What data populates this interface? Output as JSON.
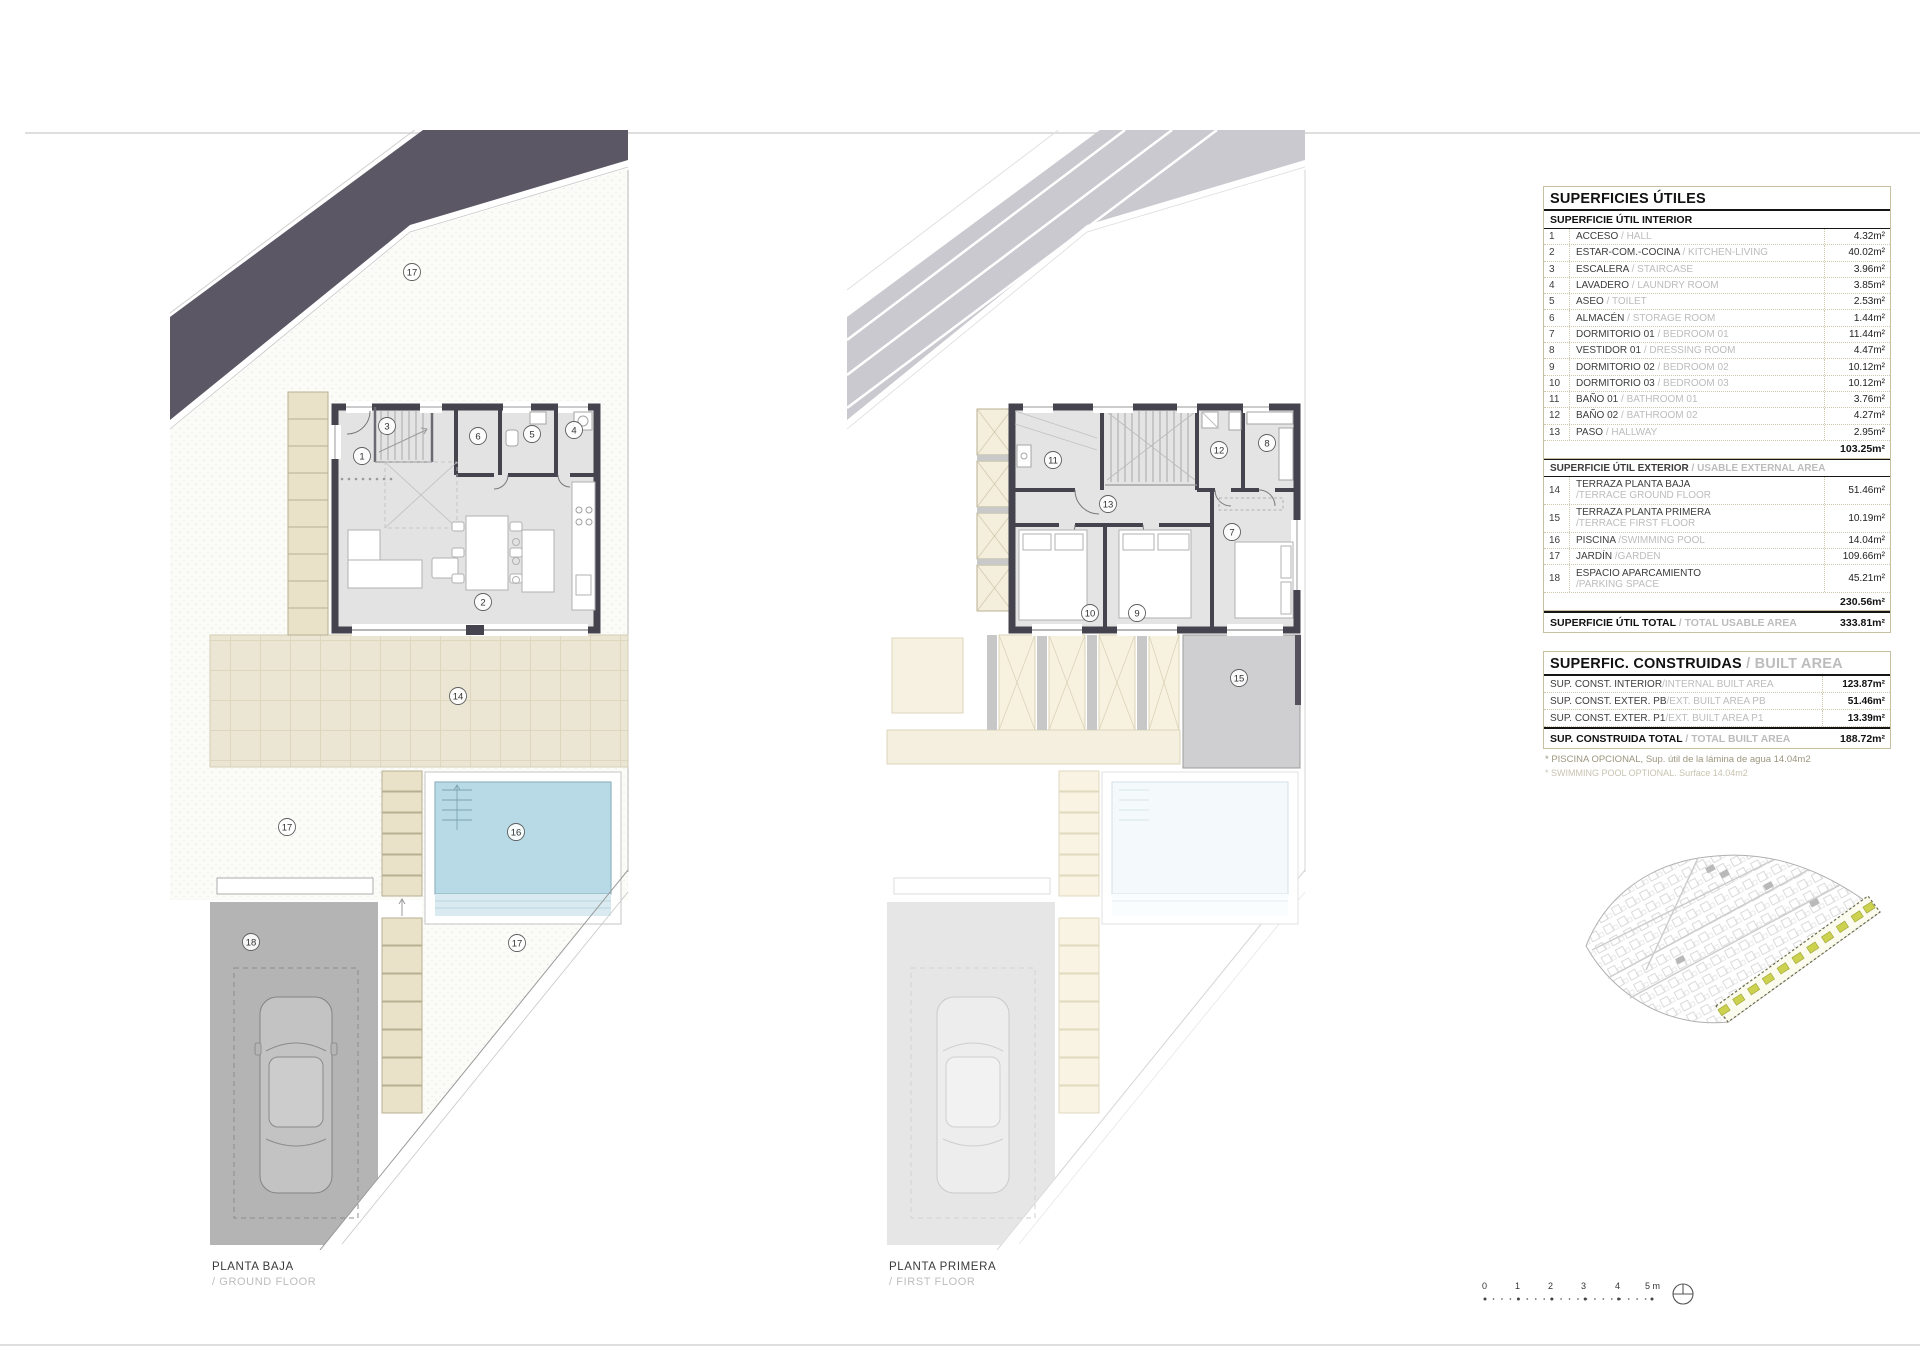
{
  "plans": {
    "ground": {
      "title": "PLANTA BAJA",
      "subtitle": "/ GROUND FLOOR",
      "room_numbers": [
        "17",
        "1",
        "3",
        "6",
        "5",
        "4",
        "2",
        "14",
        "17",
        "16",
        "18",
        "17"
      ]
    },
    "first": {
      "title": "PLANTA PRIMERA",
      "subtitle": "/ FIRST FLOOR",
      "room_numbers": [
        "11",
        "12",
        "8",
        "13",
        "7",
        "10",
        "9",
        "15"
      ]
    }
  },
  "usable_table": {
    "title": "SUPERFICIES ÚTILES",
    "interior_header": "SUPERFICIE ÚTIL INTERIOR",
    "interior_rows": [
      {
        "num": "1",
        "es": "ACCESO",
        "en": "/ HALL",
        "value": "4.32m²"
      },
      {
        "num": "2",
        "es": "ESTAR-COM.-COCINA",
        "en": "/ KITCHEN-LIVING",
        "value": "40.02m²"
      },
      {
        "num": "3",
        "es": "ESCALERA",
        "en": "/ STAIRCASE",
        "value": "3.96m²"
      },
      {
        "num": "4",
        "es": "LAVADERO",
        "en": "/ LAUNDRY ROOM",
        "value": "3.85m²"
      },
      {
        "num": "5",
        "es": "ASEO",
        "en": "/ TOILET",
        "value": "2.53m²"
      },
      {
        "num": "6",
        "es": "ALMACÉN",
        "en": "/ STORAGE ROOM",
        "value": "1.44m²"
      },
      {
        "num": "7",
        "es": "DORMITORIO 01",
        "en": "/ BEDROOM 01",
        "value": "11.44m²"
      },
      {
        "num": "8",
        "es": "VESTIDOR 01",
        "en": "/ DRESSING ROOM",
        "value": "4.47m²"
      },
      {
        "num": "9",
        "es": "DORMITORIO 02",
        "en": "/ BEDROOM 02",
        "value": "10.12m²"
      },
      {
        "num": "10",
        "es": "DORMITORIO 03",
        "en": "/ BEDROOM 03",
        "value": "10.12m²"
      },
      {
        "num": "11",
        "es": "BAÑO 01",
        "en": "/ BATHROOM 01",
        "value": "3.76m²"
      },
      {
        "num": "12",
        "es": "BAÑO 02",
        "en": "/ BATHROOM 02",
        "value": "4.27m²"
      },
      {
        "num": "13",
        "es": "PASO",
        "en": "/ HALLWAY",
        "value": "2.95m²"
      }
    ],
    "interior_subtotal": "103.25m²",
    "exterior_header_es": "SUPERFICIE ÚTIL EXTERIOR",
    "exterior_header_en": "/ USABLE EXTERNAL AREA",
    "exterior_rows": [
      {
        "num": "14",
        "es": "TERRAZA PLANTA BAJA",
        "en": "/TERRACE GROUND FLOOR",
        "value": "51.46m²"
      },
      {
        "num": "15",
        "es": "TERRAZA PLANTA PRIMERA",
        "en": "/TERRACE FIRST FLOOR",
        "value": "10.19m²"
      },
      {
        "num": "16",
        "es": "PISCINA",
        "en": "/SWIMMING POOL",
        "value": "14.04m²"
      },
      {
        "num": "17",
        "es": "JARDÍN",
        "en": "/GARDEN",
        "value": "109.66m²"
      },
      {
        "num": "18",
        "es": "ESPACIO APARCAMIENTO",
        "en": "/PARKING SPACE",
        "value": "45.21m²"
      }
    ],
    "exterior_subtotal": "230.56m²",
    "total_es": "SUPERFICIE ÚTIL TOTAL",
    "total_en": "/ TOTAL USABLE AREA",
    "total_value": "333.81m²"
  },
  "built_table": {
    "title_es": "SUPERFIC. CONSTRUIDAS",
    "title_en": "/ BUILT AREA",
    "rows": [
      {
        "es": "SUP. CONST. INTERIOR",
        "en": "/INTERNAL BUILT AREA",
        "value": "123.87m²"
      },
      {
        "es": "SUP. CONST. EXTER. PB",
        "en": "/EXT. BUILT AREA PB",
        "value": "51.46m²"
      },
      {
        "es": "SUP. CONST. EXTER. P1",
        "en": "/EXT. BUILT AREA P1",
        "value": "13.39m²"
      }
    ],
    "total_es": "SUP. CONSTRUIDA TOTAL",
    "total_en": "/ TOTAL BUILT AREA",
    "total_value": "188.72m²",
    "notes": [
      "* PISCINA OPCIONAL, Sup. útil de la lámina de agua 14.04m2",
      "* SWIMMING POOL OPTIONAL. Surface 14.04m2"
    ]
  },
  "scale_bar": {
    "ticks": [
      "0",
      "1",
      "2",
      "3",
      "4",
      "5 m"
    ]
  },
  "colors": {
    "road_band": "#5b5765",
    "pool_water": "#b7dae6",
    "terrace": "#ebe6d3",
    "parking": "#b4b4b4",
    "steps": "#e9e2c8",
    "plot_highlight": "#ccd24e",
    "table_border": "#c7c1a2",
    "wall": "#45434e"
  }
}
